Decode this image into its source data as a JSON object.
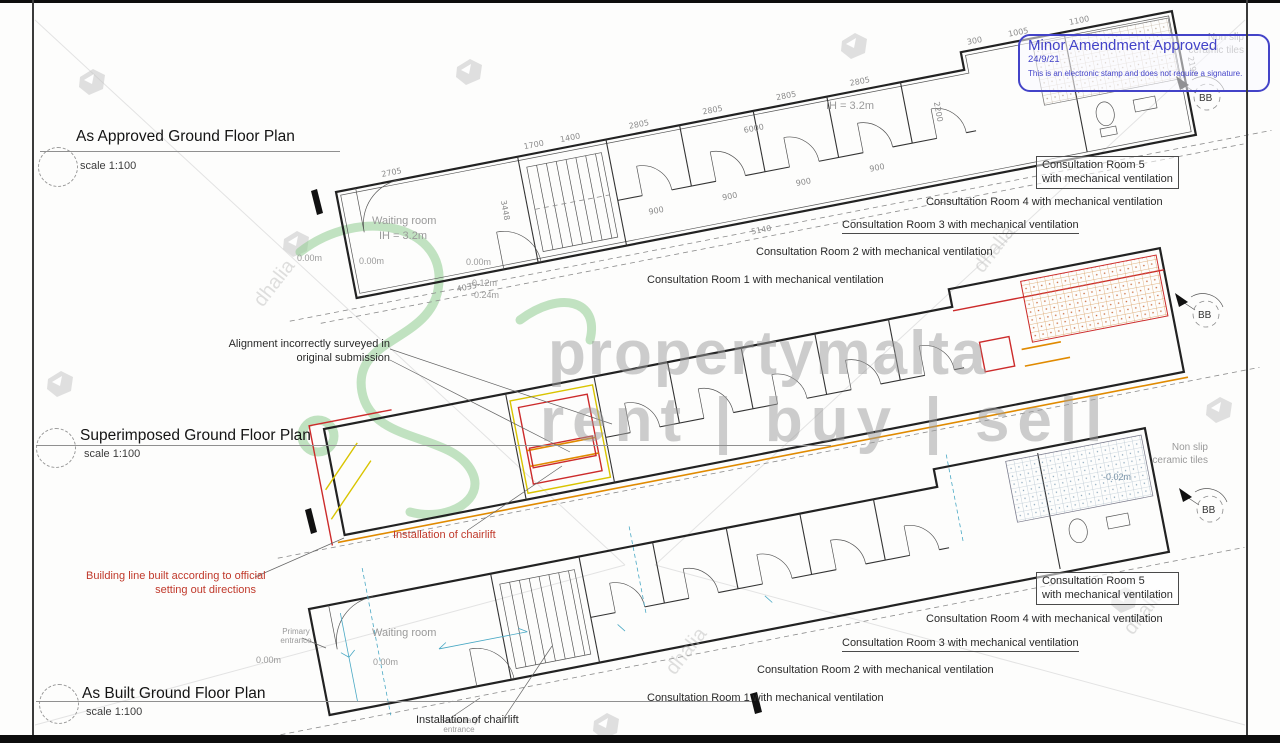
{
  "stamp": {
    "title": "Minor Amendment Approved",
    "date": "24/9/21",
    "note": "This is an electronic stamp and does not require a signature."
  },
  "titles": {
    "approved": {
      "title": "As Approved Ground Floor Plan",
      "scale": "scale 1:100"
    },
    "superimposed": {
      "title": "Superimposed Ground Floor Plan",
      "scale": "scale 1:100"
    },
    "as_built": {
      "title": "As Built Ground Floor Plan",
      "scale": "scale 1:100"
    }
  },
  "rooms": {
    "r5a": "Consultation Room 5",
    "r5b": "with mechanical ventilation",
    "r4": "Consultation Room 4 with mechanical ventilation",
    "r3": "Consultation Room 3 with mechanical ventilation",
    "r2": "Consultation Room 2 with mechanical ventilation",
    "r1": "Consultation Room 1 with mechanical ventilation",
    "waiting": "Waiting room",
    "ih": "IH = 3.2m"
  },
  "notes": {
    "alignment1": "Alignment incorrectly surveyed in",
    "alignment2": "original submission",
    "chairlift": "Installation of chairlift",
    "building_line1": "Building line built according to official",
    "building_line2": "setting out directions",
    "primary1": "Primary",
    "primary2": "entrance",
    "secondary1": "Secondary",
    "secondary2": "entrance",
    "nonslip1": "Non slip",
    "nonslip2": "ceramic tiles",
    "section": "BB"
  },
  "levels": {
    "zero": "0.00m",
    "m012": "-0.12m",
    "m024": "-0.24m",
    "m002": "-0.02m"
  },
  "dims": {
    "d2705": "2705",
    "d3448": "3448",
    "d900": "900",
    "d2200": "2200",
    "d2805": "2805",
    "d6000": "6000",
    "d1005": "1005",
    "d1700": "1700",
    "d1400": "1400",
    "d4035": "4035",
    "d300": "300",
    "d1100": "1100",
    "d2190": "2190",
    "d5140": "5140"
  },
  "watermark": {
    "brand": "propertymalta",
    "tagline": "rent | buy | sell",
    "agency": "dhalia"
  },
  "colors": {
    "stamp_blue": "#4343c8",
    "annotation_red": "#c0392b",
    "overlay_orange": "#e08a00",
    "overlay_yellow": "#d9c400",
    "survey_teal": "#49a8c4",
    "logo_green": "#8fcc8f"
  }
}
